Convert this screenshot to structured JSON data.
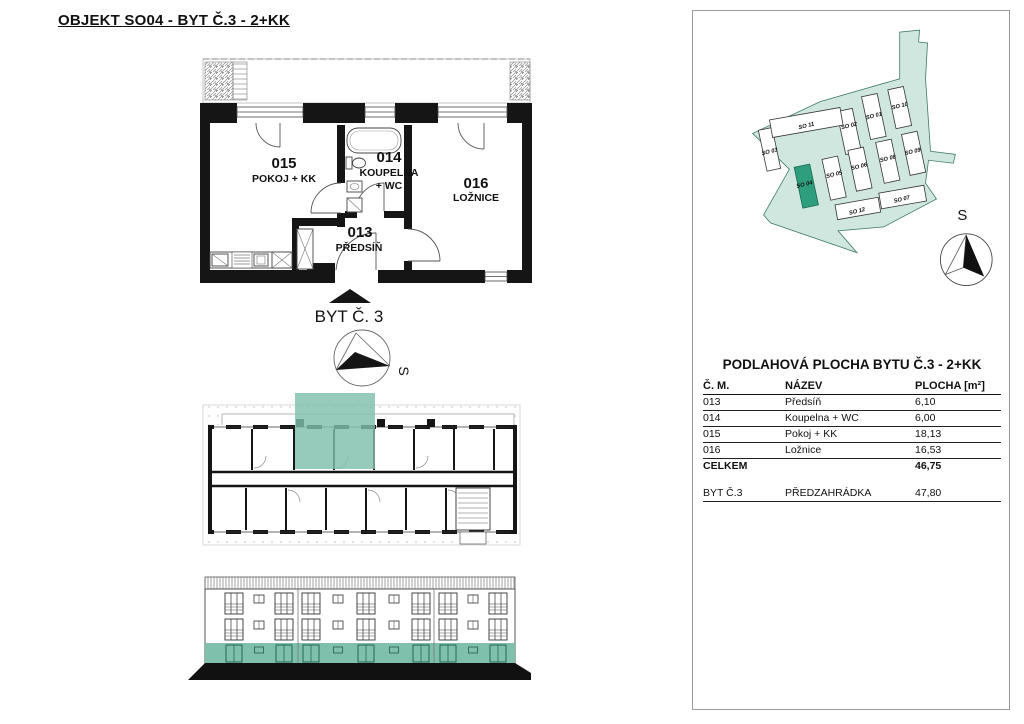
{
  "page": {
    "title": "OBJEKT SO04 - BYT Č.3 - 2+KK"
  },
  "detail_plan": {
    "unit_label": "BYT Č. 3",
    "compass_label": "S",
    "rooms": [
      {
        "num": "015",
        "name": "POKOJ + KK"
      },
      {
        "num": "014",
        "name": "KOUPELNA",
        "name2": "+ WC"
      },
      {
        "num": "016",
        "name": "LOŽNICE"
      },
      {
        "num": "013",
        "name": "PŘEDSÍŇ"
      }
    ]
  },
  "site_plan": {
    "compass_label": "S",
    "highlighted_building": "SO 04",
    "buildings": [
      {
        "label": "SO 01"
      },
      {
        "label": "SO 02"
      },
      {
        "label": "SO 03"
      },
      {
        "label": "SO 04"
      },
      {
        "label": "SO 05"
      },
      {
        "label": "SO 06"
      },
      {
        "label": "SO 07"
      },
      {
        "label": "SO 08"
      },
      {
        "label": "SO 09"
      },
      {
        "label": "SO 10"
      },
      {
        "label": "SO 11"
      },
      {
        "label": "SO 12"
      }
    ]
  },
  "area_table": {
    "title": "PODLAHOVÁ PLOCHA BYTU Č.3 - 2+KK",
    "headers": [
      "Č. M.",
      "NÁZEV",
      "PLOCHA [m²]"
    ],
    "rows": [
      {
        "num": "013",
        "name": "Předsíň",
        "area": "6,10"
      },
      {
        "num": "014",
        "name": "Koupelna + WC",
        "area": "6,00"
      },
      {
        "num": "015",
        "name": "Pokoj + KK",
        "area": "18,13"
      },
      {
        "num": "016",
        "name": "Ložnice",
        "area": "16,53"
      }
    ],
    "total_label": "CELKEM",
    "total_value": "46,75",
    "extra_row": {
      "num": "BYT Č.3",
      "name": "PŘEDZAHRÁDKA",
      "area": "47,80"
    }
  },
  "colors": {
    "highlight_teal": "#7FC0AD",
    "site_background": "#CFE7DF",
    "site_highlight": "#2F9E7E"
  }
}
